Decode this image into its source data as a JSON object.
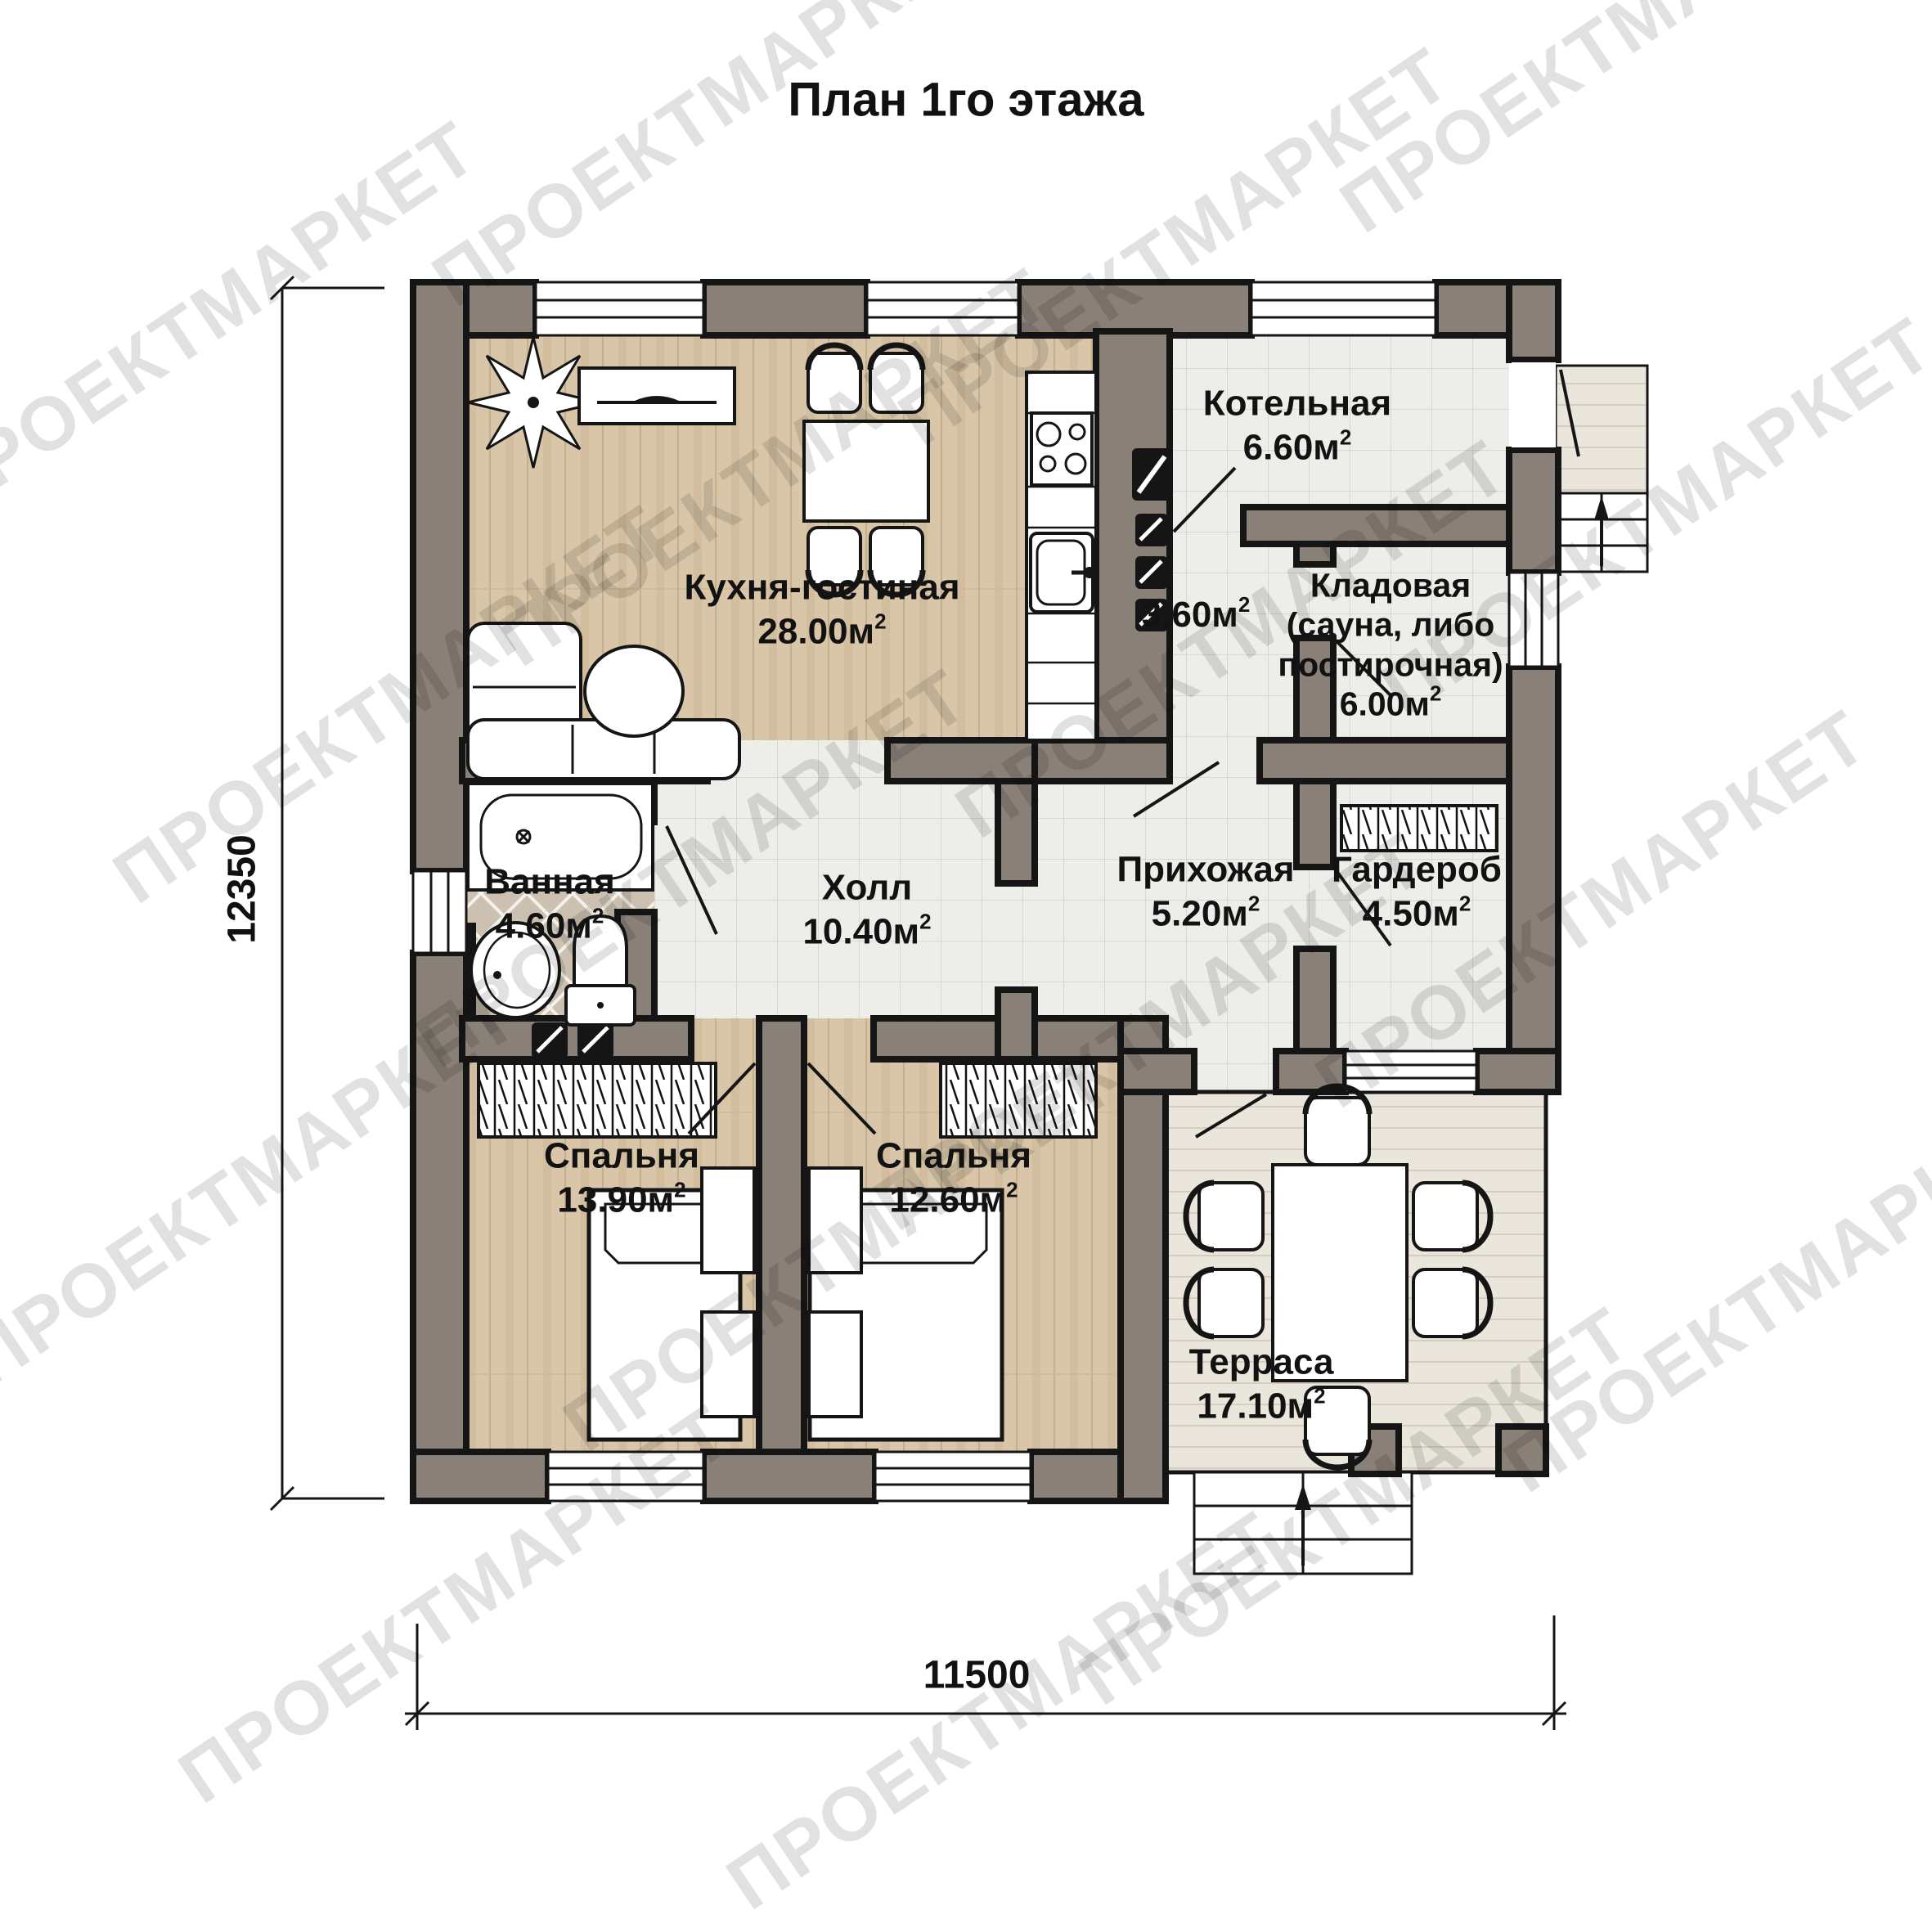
{
  "title": "План 1го этажа",
  "watermark": {
    "text": "ПРОЕКТМАРКЕТ"
  },
  "dimensions": {
    "height_mm": "12350",
    "width_mm": "11500"
  },
  "superscript": "2",
  "rooms": {
    "kitchen_living": {
      "name": "Кухня-гостиная",
      "area": "28.00м"
    },
    "boiler": {
      "name": "Котельная",
      "area": "6.60м"
    },
    "corridor": {
      "area": "3.60м"
    },
    "storage": {
      "name_line1": "Кладовая",
      "name_line2": "(сауна, либо",
      "name_line3": "постирочная)",
      "area": "6.00м"
    },
    "bathroom": {
      "name": "Ванная",
      "area": "4.60м"
    },
    "hall": {
      "name": "Холл",
      "area": "10.40м"
    },
    "entry": {
      "name": "Прихожая",
      "area": "5.20м"
    },
    "wardrobe": {
      "name": "Гардероб",
      "area": "4.50м"
    },
    "bedroom1": {
      "name": "Спальня",
      "area": "13.90м"
    },
    "bedroom2": {
      "name": "Спальня",
      "area": "12.60м"
    },
    "terrace": {
      "name": "Терраса",
      "area": "17.10м"
    }
  },
  "colors": {
    "wall_fill": "#898077",
    "outline": "#151515",
    "wood_floor": "#d9c6a9",
    "tile_floor": "#ededea",
    "bath_floor": "#ccc1b1",
    "deck_floor": "#eae6db",
    "watermark": "#9a9a9a"
  }
}
